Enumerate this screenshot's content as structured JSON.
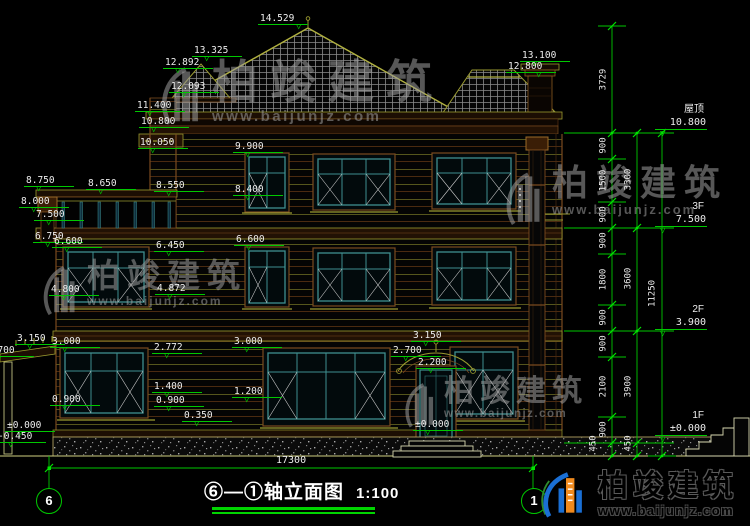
{
  "drawing": {
    "title": "⑥—①轴立面图",
    "scale": "1:100"
  },
  "axes": [
    {
      "label": "6"
    },
    {
      "label": "1"
    }
  ],
  "bottom_dim": {
    "value": "17300"
  },
  "floor_markers": [
    {
      "name": "屋顶",
      "v": "10.800",
      "x": 655,
      "y": 104
    },
    {
      "name": "3F",
      "v": "7.500",
      "x": 655,
      "y": 201
    },
    {
      "name": "2F",
      "v": "3.900",
      "x": 655,
      "y": 304
    },
    {
      "name": "1F",
      "v": "±0.000",
      "x": 655,
      "y": 410
    }
  ],
  "elevation_markers": [
    {
      "v": "14.529",
      "x": 258,
      "y": 13,
      "s": "--t:38px"
    },
    {
      "v": "13.325",
      "x": 192,
      "y": 45
    },
    {
      "v": "12.892",
      "x": 163,
      "y": 57
    },
    {
      "v": "12.093",
      "x": 169,
      "y": 81
    },
    {
      "v": "11.400",
      "x": 135,
      "y": 100
    },
    {
      "v": "10.800",
      "x": 139,
      "y": 116
    },
    {
      "v": "10.050",
      "x": 138,
      "y": 137
    },
    {
      "v": "9.900",
      "x": 233,
      "y": 141
    },
    {
      "v": "8.400",
      "x": 233,
      "y": 184
    },
    {
      "v": "13.100",
      "x": 520,
      "y": 50
    },
    {
      "v": "12.800",
      "x": 506,
      "y": 61,
      "s": "--t:30px"
    },
    {
      "v": "8.750",
      "x": 24,
      "y": 175
    },
    {
      "v": "8.650",
      "x": 86,
      "y": 178
    },
    {
      "v": "8.550",
      "x": 154,
      "y": 180
    },
    {
      "v": "8.000",
      "x": 19,
      "y": 196
    },
    {
      "v": "7.500",
      "x": 34,
      "y": 209
    },
    {
      "v": "6.750",
      "x": 33,
      "y": 231
    },
    {
      "v": "6.600",
      "x": 52,
      "y": 236
    },
    {
      "v": "6.450",
      "x": 154,
      "y": 240
    },
    {
      "v": "6.600",
      "x": 234,
      "y": 234
    },
    {
      "v": "4.800",
      "x": 49,
      "y": 284
    },
    {
      "v": "4.872",
      "x": 155,
      "y": 283
    },
    {
      "v": "3.150",
      "x": 15,
      "y": 333
    },
    {
      "v": "3.000",
      "x": 50,
      "y": 336
    },
    {
      "v": "2.700",
      "x": -16,
      "y": 345
    },
    {
      "v": "2.772",
      "x": 152,
      "y": 342
    },
    {
      "v": "3.000",
      "x": 232,
      "y": 336
    },
    {
      "v": "1.400",
      "x": 152,
      "y": 381
    },
    {
      "v": "1.200",
      "x": 232,
      "y": 386
    },
    {
      "v": "0.900",
      "x": 50,
      "y": 394
    },
    {
      "v": "0.900",
      "x": 154,
      "y": 395
    },
    {
      "v": "0.350",
      "x": 182,
      "y": 410
    },
    {
      "v": "±0.000",
      "x": 5,
      "y": 420
    },
    {
      "v": "-0.450",
      "x": -4,
      "y": 431
    },
    {
      "v": "3.150",
      "x": 411,
      "y": 330
    },
    {
      "v": "2.700",
      "x": 391,
      "y": 345
    },
    {
      "v": "2.200",
      "x": 416,
      "y": 357
    },
    {
      "v": "±0.000",
      "x": 413,
      "y": 419
    }
  ],
  "dim_chain_labels": [
    {
      "v": "3729",
      "x": 584,
      "y": 73
    },
    {
      "v": "900",
      "x": 584,
      "y": 139
    },
    {
      "v": "1500",
      "x": 584,
      "y": 174
    },
    {
      "v": "900",
      "x": 584,
      "y": 208
    },
    {
      "v": "900",
      "x": 584,
      "y": 234
    },
    {
      "v": "1800",
      "x": 584,
      "y": 273
    },
    {
      "v": "900",
      "x": 584,
      "y": 311
    },
    {
      "v": "900",
      "x": 584,
      "y": 337
    },
    {
      "v": "2100",
      "x": 584,
      "y": 380
    },
    {
      "v": "900",
      "x": 584,
      "y": 423
    },
    {
      "v": "450",
      "x": 574,
      "y": 437
    },
    {
      "v": "3300",
      "x": 609,
      "y": 173
    },
    {
      "v": "3600",
      "x": 609,
      "y": 272
    },
    {
      "v": "3900",
      "x": 609,
      "y": 380
    },
    {
      "v": "450",
      "x": 609,
      "y": 437
    },
    {
      "v": "11250",
      "x": 633,
      "y": 287
    }
  ],
  "watermarks": [
    {
      "brand": "柏竣建筑",
      "url": "www.baijunjz.com",
      "x": 158,
      "y": 58,
      "cls": "wm-a"
    },
    {
      "brand": "柏竣建筑",
      "url": "www.baijunjz.com",
      "x": 40,
      "y": 258,
      "cls": "wm-b"
    },
    {
      "brand": "柏竣建筑",
      "url": "www.baijunjz.com",
      "x": 503,
      "y": 164,
      "cls": "wm-c"
    },
    {
      "brand": "柏竣建筑",
      "url": "www.baijunjz.com",
      "x": 402,
      "y": 376,
      "cls": "wm-d"
    }
  ],
  "logo": {
    "brand": "柏竣建筑",
    "url": "www.baijunjz.com"
  },
  "colors": {
    "dim_line": "#00c800",
    "dim_bright": "#00e400",
    "dim_text": "#ededed",
    "trim_olive": "#9a9a30",
    "trim_brown": "#7a4a1f",
    "window_teal": "#3f8f8f",
    "logo_blue": "#1a6fd4",
    "logo_orange": "#f08a1e",
    "logo_green": "#2e8b2e"
  }
}
